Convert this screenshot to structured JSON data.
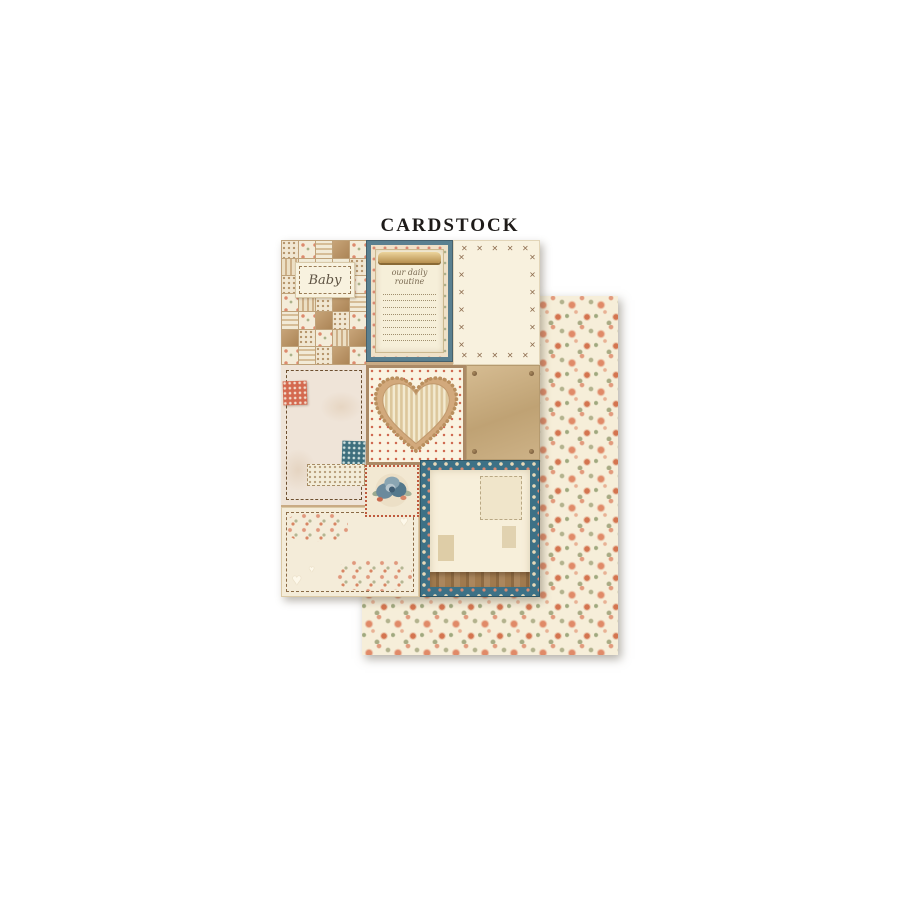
{
  "title": "CARDSTOCK",
  "colors": {
    "teal_notepad_frame": "#5a8090",
    "teal_panel_frame": "#3d7186",
    "coral_patch": "#d4694f",
    "teal_patch": "#3e6f7d",
    "kraft_tan": "#c9ab84",
    "cream_paper": "#f6efd9",
    "stitch_brown": "#8d6c4e",
    "rose_coral": "#e08a68",
    "leaf_green": "#a8aa83",
    "floral_background": "#f6eed9"
  },
  "back_sheet": {
    "pattern": "small-roses-floral"
  },
  "front_sheet": {
    "baby_label": {
      "text": "Baby"
    },
    "notepad_panel": {
      "title": "our daily routine",
      "line_count": 8
    },
    "cross_stitch_panel": {
      "stitch_char": "✕"
    },
    "patchwork": {
      "squares": [
        "p-dots",
        "p-floral",
        "p-stripeh",
        "p-tan",
        "p-floral",
        "p-stripev",
        "p-cream",
        "p-cream",
        "p-cream",
        "p-dots",
        "p-dots",
        "p-cream",
        "p-cream",
        "p-cream",
        "p-floral",
        "p-floral",
        "p-stripev",
        "p-dots",
        "p-tan",
        "p-stripeh",
        "p-stripeh",
        "p-floral",
        "p-tan",
        "p-dots",
        "p-floral",
        "p-tan",
        "p-dots",
        "p-floral",
        "p-stripev",
        "p-tan",
        "p-floral",
        "p-stripeh",
        "p-dots",
        "p-tan",
        "p-floral"
      ]
    },
    "bottom_left_panel": {
      "heart_icons": [
        "♥",
        "♥",
        "♥"
      ]
    }
  }
}
